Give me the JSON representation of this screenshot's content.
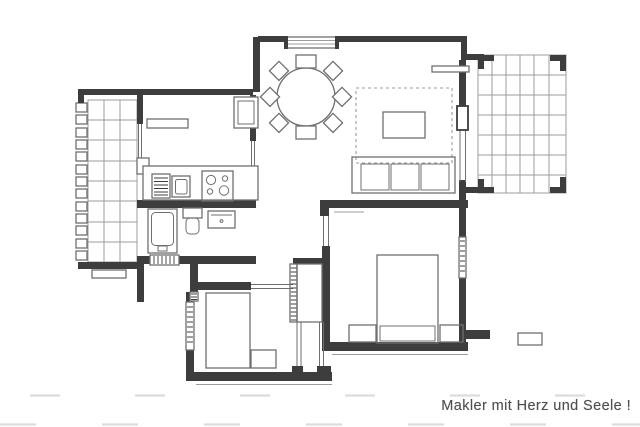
{
  "caption": {
    "text": "Makler mit Herz und Seele !"
  },
  "colors": {
    "paper": "#ffffff",
    "wall": "#3d3d3d",
    "line": "#6f6f6f",
    "grid": "#9c9c9c",
    "faint": "#dcdcdc",
    "caption_text": "#4e4e4e"
  }
}
